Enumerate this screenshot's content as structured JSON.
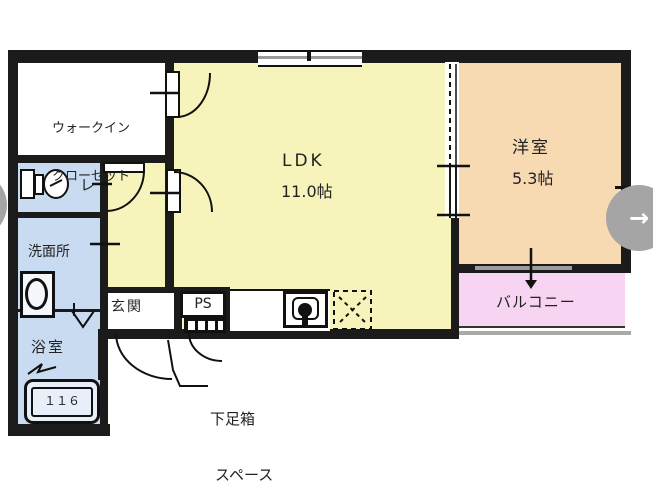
{
  "rooms": {
    "wic": {
      "label_line1": "ウォークイン",
      "label_line2": "クローゼット"
    },
    "ldk": {
      "label": "LDK",
      "size": "11.0帖"
    },
    "western": {
      "label": "洋室",
      "size": "5.3帖"
    },
    "toilet": {
      "label": "レ"
    },
    "washroom": {
      "label": "洗面所"
    },
    "bathroom": {
      "label": "浴室",
      "tub_label": "１１６"
    },
    "entrance": {
      "label": "玄関"
    },
    "pipe_space": {
      "label": "PS"
    },
    "balcony": {
      "label": "バルコニー"
    }
  },
  "annotations": {
    "shoe_note_line1": "下足箱",
    "shoe_note_line2": "スペース"
  },
  "carousel": {
    "next_label": "→",
    "prev_label": "←"
  },
  "colors": {
    "wall": "#1b1b1b",
    "ldk": "#f7f4bb",
    "western": "#f7d9b2",
    "balcony": "#f6d4f2",
    "wet": "#c9dbf0",
    "window": "#9b9b9b",
    "button": "#a5a5a5",
    "text": "#222222"
  }
}
